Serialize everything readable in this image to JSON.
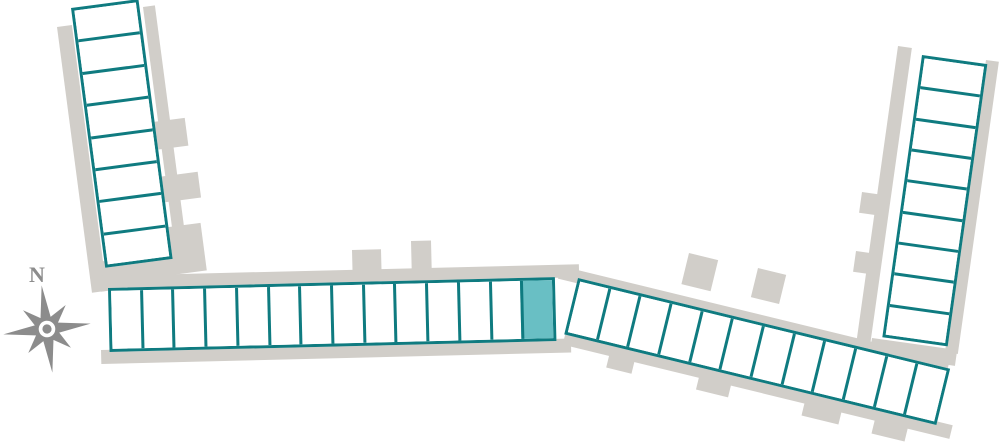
{
  "title": "facility-site-map",
  "compass": {
    "north_label": "N"
  },
  "colors": {
    "outline": "#0f7b80",
    "unit_fill": "#ffffff",
    "selected_fill": "#69bfc4",
    "pavement": "#d1cec9",
    "compass": "#8c8c8c"
  },
  "buildings": [
    {
      "id": "west-column",
      "orientation": "vertical",
      "unit_count": 8,
      "selected_units": []
    },
    {
      "id": "south-row",
      "orientation": "horizontal",
      "unit_count": 14,
      "selected_units": [
        14
      ]
    },
    {
      "id": "southeast-row",
      "orientation": "horizontal",
      "unit_count": 12,
      "selected_units": []
    },
    {
      "id": "east-column",
      "orientation": "vertical",
      "unit_count": 9,
      "selected_units": []
    }
  ]
}
